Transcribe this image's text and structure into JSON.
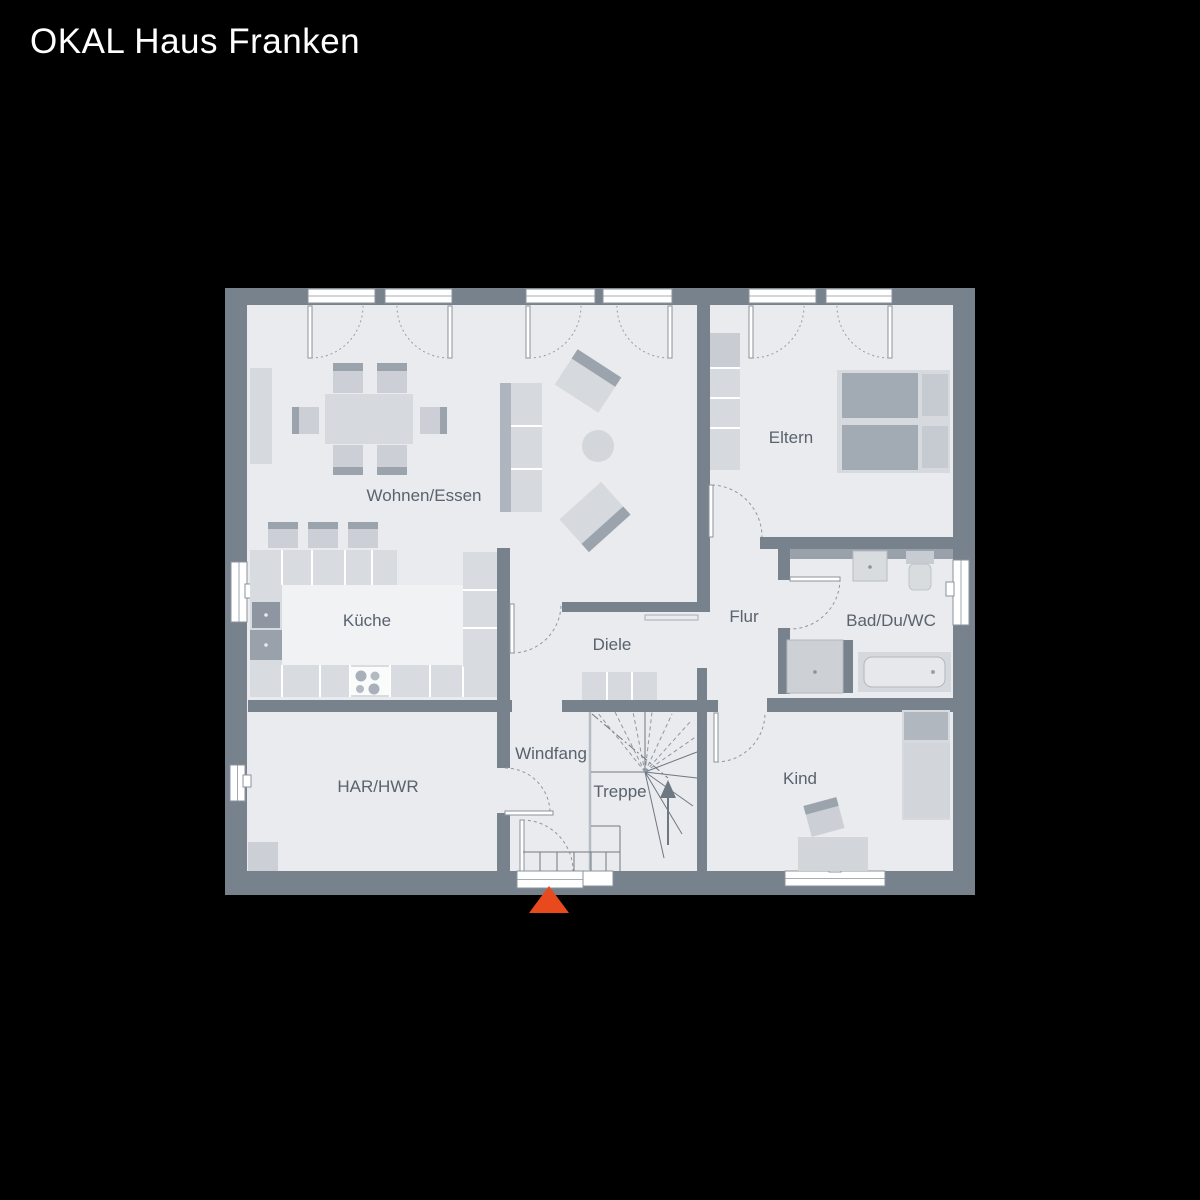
{
  "title": "OKAL Haus Franken",
  "colors": {
    "background": "#000000",
    "wall": "#78828d",
    "floor": "#e9ebee",
    "furniture_light": "#d6d9dd",
    "furniture_dark": "#9ba3ad",
    "label_text": "#59626e",
    "window_white": "#ffffff",
    "entrance_arrow": "#e8491d"
  },
  "rooms": [
    {
      "id": "wohnen_essen",
      "label": "Wohnen/Essen"
    },
    {
      "id": "eltern",
      "label": "Eltern"
    },
    {
      "id": "kueche",
      "label": "Küche"
    },
    {
      "id": "flur",
      "label": "Flur"
    },
    {
      "id": "bad_du_wc",
      "label": "Bad/Du/WC"
    },
    {
      "id": "diele",
      "label": "Diele"
    },
    {
      "id": "windfang",
      "label": "Windfang"
    },
    {
      "id": "treppe",
      "label": "Treppe"
    },
    {
      "id": "har_hwr",
      "label": "HAR/HWR"
    },
    {
      "id": "kind",
      "label": "Kind"
    }
  ],
  "entrance": {
    "marker": "entrance-arrow",
    "direction": "up"
  }
}
